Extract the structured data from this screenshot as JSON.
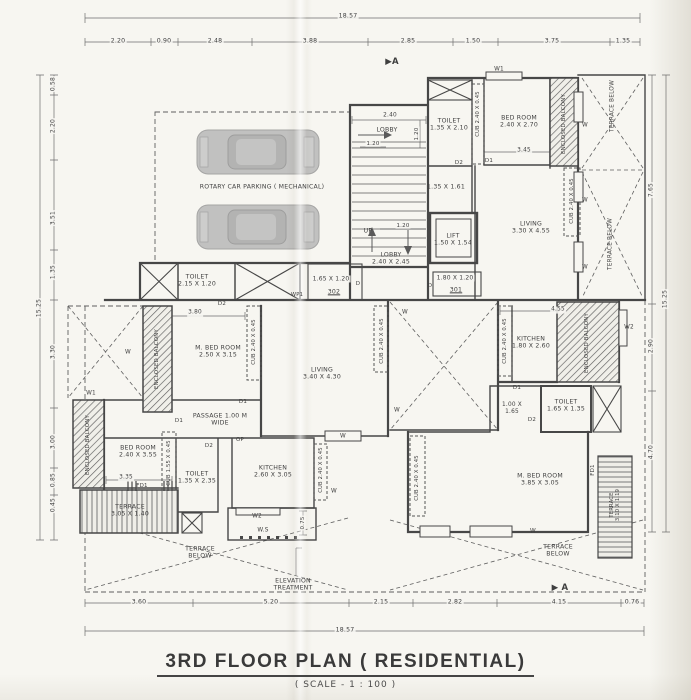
{
  "meta": {
    "title": "3RD FLOOR PLAN ( RESIDENTIAL)",
    "scale_note": "( SCALE - 1 : 100 )"
  },
  "colors": {
    "paper": "#f7f6f1",
    "ink": "#474747",
    "dim_line": "#6e6e6e",
    "car_body": "#b8b8b8"
  },
  "annotations": [
    {
      "name": "dim-top-total",
      "text": "18.57",
      "x": 348,
      "y": 16,
      "size": 6.2,
      "bg": true
    },
    {
      "name": "dim-top-1",
      "text": "2.20",
      "x": 118,
      "y": 41,
      "size": 6.2,
      "bg": true
    },
    {
      "name": "dim-top-2",
      "text": "0.90",
      "x": 164,
      "y": 41,
      "size": 6.2,
      "bg": true
    },
    {
      "name": "dim-top-3",
      "text": "2.48",
      "x": 215,
      "y": 41,
      "size": 6.2,
      "bg": true
    },
    {
      "name": "dim-top-4",
      "text": "3.88",
      "x": 310,
      "y": 41,
      "size": 6.2,
      "bg": true
    },
    {
      "name": "dim-top-5",
      "text": "2.85",
      "x": 408,
      "y": 41,
      "size": 6.2,
      "bg": true
    },
    {
      "name": "dim-top-6",
      "text": "1.50",
      "x": 473,
      "y": 41,
      "size": 6.2,
      "bg": true
    },
    {
      "name": "dim-top-7",
      "text": "3.75",
      "x": 552,
      "y": 41,
      "size": 6.2,
      "bg": true
    },
    {
      "name": "dim-top-8",
      "text": "1.35",
      "x": 623,
      "y": 41,
      "size": 6.2,
      "bg": true
    },
    {
      "name": "dim-bottom-1",
      "text": "3.60",
      "x": 139,
      "y": 602,
      "size": 6.2,
      "bg": true
    },
    {
      "name": "dim-bottom-2",
      "text": "5.20",
      "x": 271,
      "y": 602,
      "size": 6.2,
      "bg": true
    },
    {
      "name": "dim-bottom-3",
      "text": "2.15",
      "x": 381,
      "y": 602,
      "size": 6.2,
      "bg": true
    },
    {
      "name": "dim-bottom-4",
      "text": "2.82",
      "x": 455,
      "y": 602,
      "size": 6.2,
      "bg": true
    },
    {
      "name": "dim-bottom-5",
      "text": "4.15",
      "x": 559,
      "y": 602,
      "size": 6.2,
      "bg": true
    },
    {
      "name": "dim-bottom-6",
      "text": "0.76",
      "x": 632,
      "y": 602,
      "size": 6.2,
      "bg": true
    },
    {
      "name": "dim-bottom-total",
      "text": "18.57",
      "x": 345,
      "y": 630,
      "size": 6.2,
      "bg": true
    },
    {
      "name": "dim-left-1",
      "text": "0.58",
      "x": 53,
      "y": 84,
      "rot": -90,
      "size": 6,
      "bg": true
    },
    {
      "name": "dim-left-2",
      "text": "2.20",
      "x": 53,
      "y": 126,
      "rot": -90,
      "size": 6,
      "bg": true
    },
    {
      "name": "dim-left-3",
      "text": "3.51",
      "x": 53,
      "y": 218,
      "rot": -90,
      "size": 6,
      "bg": true
    },
    {
      "name": "dim-left-4",
      "text": "1.35",
      "x": 53,
      "y": 272,
      "rot": -90,
      "size": 6,
      "bg": true
    },
    {
      "name": "dim-left-total",
      "text": "15.25",
      "x": 39,
      "y": 308,
      "rot": -90,
      "size": 6,
      "bg": true
    },
    {
      "name": "dim-left-5",
      "text": "3.30",
      "x": 53,
      "y": 352,
      "rot": -90,
      "size": 6,
      "bg": true
    },
    {
      "name": "dim-left-6",
      "text": "3.00",
      "x": 53,
      "y": 442,
      "rot": -90,
      "size": 6,
      "bg": true
    },
    {
      "name": "dim-left-7",
      "text": "0.85",
      "x": 53,
      "y": 480,
      "rot": -90,
      "size": 6,
      "bg": true
    },
    {
      "name": "dim-left-8",
      "text": "0.45",
      "x": 53,
      "y": 505,
      "rot": -90,
      "size": 6,
      "bg": true
    },
    {
      "name": "dim-right-1",
      "text": "7.65",
      "x": 651,
      "y": 190,
      "rot": -90,
      "size": 6,
      "bg": true
    },
    {
      "name": "dim-right-2",
      "text": "2.90",
      "x": 651,
      "y": 346,
      "rot": -90,
      "size": 6,
      "bg": true
    },
    {
      "name": "dim-right-3",
      "text": "4.70",
      "x": 651,
      "y": 452,
      "rot": -90,
      "size": 6,
      "bg": true
    },
    {
      "name": "dim-right-total",
      "text": "15.25",
      "x": 665,
      "y": 299,
      "rot": -90,
      "size": 6,
      "bg": true
    },
    {
      "name": "section-marker-top",
      "text": "▶A",
      "x": 392,
      "y": 62,
      "size": 8.5,
      "bold": true
    },
    {
      "name": "section-marker-bottom",
      "text": "▶ A",
      "x": 560,
      "y": 588,
      "size": 8.5,
      "bold": true
    },
    {
      "name": "parking-label",
      "text": "ROTARY CAR PARKING ( MECHANICAL)",
      "x": 262,
      "y": 187,
      "size": 6.2
    },
    {
      "name": "dim-stair-width",
      "text": "2.40",
      "x": 390,
      "y": 116,
      "size": 5.8,
      "bg": true
    },
    {
      "name": "lobby-upper-label",
      "text": "LOBBY",
      "x": 387,
      "y": 130,
      "size": 6.2
    },
    {
      "name": "dim-lobby-1",
      "text": "1.20",
      "x": 373,
      "y": 144,
      "size": 5.5,
      "bg": true
    },
    {
      "name": "dim-lobby-2",
      "text": "1.20",
      "x": 417,
      "y": 134,
      "rot": -90,
      "size": 5.5,
      "bg": true
    },
    {
      "name": "stair-up-label",
      "text": "UP",
      "x": 368,
      "y": 231,
      "size": 6.2
    },
    {
      "name": "dim-stair-landing",
      "text": "1.20",
      "x": 403,
      "y": 226,
      "size": 5.5,
      "bg": true
    },
    {
      "name": "lobby-main-label",
      "text": "LOBBY\n2.40 X 2.45",
      "x": 391,
      "y": 259,
      "size": 6.2
    },
    {
      "name": "lift-label",
      "text": "LIFT\n1.50 X 1.54",
      "x": 453,
      "y": 240,
      "size": 6.2
    },
    {
      "name": "passage-161-label",
      "text": "1.35 X 1.61",
      "x": 446,
      "y": 187,
      "size": 6.2
    },
    {
      "name": "duct-301-size",
      "text": "1.80 X 1.20",
      "x": 455,
      "y": 278,
      "size": 6,
      "bg": true
    },
    {
      "name": "duct-301-label",
      "text": "301",
      "x": 456,
      "y": 290,
      "size": 6.2,
      "underline": true
    },
    {
      "name": "door-301",
      "text": "D",
      "x": 430,
      "y": 286,
      "size": 5.5
    },
    {
      "name": "duct-302-size",
      "text": "1.65 X 1.20",
      "x": 331,
      "y": 279,
      "size": 6,
      "bg": true
    },
    {
      "name": "duct-302-label",
      "text": "302",
      "x": 334,
      "y": 292,
      "size": 6.2,
      "underline": true
    },
    {
      "name": "door-302",
      "text": "D",
      "x": 358,
      "y": 284,
      "size": 5.5
    },
    {
      "name": "vent-wp1",
      "text": "WP1",
      "x": 297,
      "y": 295,
      "size": 5.2
    },
    {
      "name": "toilet-tr-label",
      "text": "TOILET\n1.35 X 2.10",
      "x": 449,
      "y": 125,
      "size": 6.2
    },
    {
      "name": "cub-tr-label",
      "text": "CUB 2.40 X 0.45",
      "x": 478,
      "y": 114,
      "rot": -90,
      "size": 5.2
    },
    {
      "name": "bedroom-tr-label",
      "text": "BED ROOM\n2.40 X 2.70",
      "x": 519,
      "y": 122,
      "size": 6.2
    },
    {
      "name": "window-w1-top",
      "text": "W1",
      "x": 499,
      "y": 70,
      "size": 5.8
    },
    {
      "name": "balcony-tr-label",
      "text": "ENCLOSED BALCONY",
      "x": 564,
      "y": 124,
      "rot": -90,
      "size": 5.4
    },
    {
      "name": "dim-bedroom-tr",
      "text": "3.45",
      "x": 524,
      "y": 151,
      "size": 5.8,
      "bg": true
    },
    {
      "name": "door-d2-tr",
      "text": "D2",
      "x": 459,
      "y": 163,
      "size": 5.5
    },
    {
      "name": "door-d1-tr",
      "text": "D1",
      "x": 489,
      "y": 161,
      "size": 5.5
    },
    {
      "name": "living-tr-label",
      "text": "LIVING\n3.30 X 4.55",
      "x": 531,
      "y": 228,
      "size": 6.2
    },
    {
      "name": "cub-tr2-label",
      "text": "CUB 2.40 X 0.45",
      "x": 572,
      "y": 201,
      "rot": -90,
      "size": 5.2
    },
    {
      "name": "window-w-tr1",
      "text": "W",
      "x": 585,
      "y": 126,
      "size": 5.8
    },
    {
      "name": "window-w-tr2",
      "text": "W",
      "x": 585,
      "y": 201,
      "size": 5.8
    },
    {
      "name": "window-w-tr3",
      "text": "W",
      "x": 585,
      "y": 268,
      "size": 5.8
    },
    {
      "name": "terrace-below-tr1",
      "text": "TERRACE BELOW",
      "x": 613,
      "y": 106,
      "rot": -90,
      "size": 5.8
    },
    {
      "name": "terrace-below-tr2",
      "text": "TERRACE BELOW",
      "x": 611,
      "y": 244,
      "rot": -90,
      "size": 5.8
    },
    {
      "name": "toilet-tl-label",
      "text": "TOILET\n2.15 X 1.20",
      "x": 197,
      "y": 281,
      "size": 6.2
    },
    {
      "name": "door-d2-tl",
      "text": "D2",
      "x": 222,
      "y": 304,
      "size": 5.5
    },
    {
      "name": "dim-mbed-tl",
      "text": "3.80",
      "x": 195,
      "y": 313,
      "size": 5.8,
      "bg": true
    },
    {
      "name": "window-w-ml",
      "text": "W",
      "x": 128,
      "y": 353,
      "size": 5.8
    },
    {
      "name": "balcony-ml-label",
      "text": "ENCLOSED BALCONY",
      "x": 157,
      "y": 359,
      "rot": -90,
      "size": 5.4
    },
    {
      "name": "mbedroom-ml-label",
      "text": "M. BED ROOM\n2.50 X 3.15",
      "x": 218,
      "y": 352,
      "size": 6.2
    },
    {
      "name": "cub-ml-label",
      "text": "CUB 2.40 X 0.45",
      "x": 254,
      "y": 342,
      "rot": -90,
      "size": 5.2
    },
    {
      "name": "living-ml-label",
      "text": "LIVING\n3.40 X 4.30",
      "x": 322,
      "y": 374,
      "size": 6.2
    },
    {
      "name": "window-w1-ml",
      "text": "W1",
      "x": 91,
      "y": 394,
      "size": 5.8
    },
    {
      "name": "balcony-ml2-label",
      "text": "ENCLOSED BALCONY",
      "x": 88,
      "y": 445,
      "rot": -90,
      "size": 5.4
    },
    {
      "name": "passage-label",
      "text": "PASSAGE 1.00 M\nWIDE",
      "x": 220,
      "y": 420,
      "size": 6.2
    },
    {
      "name": "door-d1-passage",
      "text": "D1",
      "x": 179,
      "y": 421,
      "size": 5.5
    },
    {
      "name": "door-d1-living",
      "text": "D1",
      "x": 243,
      "y": 402,
      "size": 5.5
    },
    {
      "name": "opening-op",
      "text": "OP",
      "x": 240,
      "y": 440,
      "size": 5.5
    },
    {
      "name": "bedroom-bl-label",
      "text": "BED ROOM\n2.40 X 3.55",
      "x": 138,
      "y": 452,
      "size": 6.2
    },
    {
      "name": "cub-bl-label",
      "text": "CUB 1.55 X 0.45",
      "x": 169,
      "y": 463,
      "rot": -90,
      "size": 5.2
    },
    {
      "name": "door-d2-bl",
      "text": "D2",
      "x": 209,
      "y": 446,
      "size": 5.5
    },
    {
      "name": "toilet-bl-label",
      "text": "TOILET\n1.35 X 2.35",
      "x": 197,
      "y": 478,
      "size": 6.2
    },
    {
      "name": "kitchen-bl-label",
      "text": "KITCHEN\n2.60 X 3.05",
      "x": 273,
      "y": 472,
      "size": 6.2
    },
    {
      "name": "dim-bedroom-bl",
      "text": "3.35",
      "x": 126,
      "y": 478,
      "size": 5.8,
      "bg": true
    },
    {
      "name": "door-fd1-bl",
      "text": "FD1",
      "x": 142,
      "y": 486,
      "size": 5.5
    },
    {
      "name": "terrace-bl-label",
      "text": "TERRACE\n3.05 X 1.40",
      "x": 130,
      "y": 511,
      "size": 6.2
    },
    {
      "name": "cub-kitchen-bl",
      "text": "CUB 2.40 X 0.45",
      "x": 321,
      "y": 470,
      "rot": -90,
      "size": 5.2
    },
    {
      "name": "window-w-kitchen-bl",
      "text": "W",
      "x": 334,
      "y": 492,
      "size": 5.8
    },
    {
      "name": "window-w-living-b",
      "text": "W",
      "x": 343,
      "y": 437,
      "size": 5.8
    },
    {
      "name": "window-w-living-r",
      "text": "W",
      "x": 397,
      "y": 411,
      "size": 5.8
    },
    {
      "name": "dim-kitchen-tr",
      "text": "4.55",
      "x": 558,
      "y": 310,
      "size": 5.8,
      "bg": true
    },
    {
      "name": "kitchen-mr-label",
      "text": "KITCHEN\n1.80 X 2.60",
      "x": 531,
      "y": 343,
      "size": 6.2
    },
    {
      "name": "cub-mr1-label",
      "text": "CUB 2.40 X 0.45",
      "x": 505,
      "y": 341,
      "rot": -90,
      "size": 5.2
    },
    {
      "name": "cub-mr2-label",
      "text": "CUB 2.40 X 0.45",
      "x": 382,
      "y": 341,
      "rot": -90,
      "size": 5.2
    },
    {
      "name": "window-w-mr",
      "text": "W",
      "x": 405,
      "y": 313,
      "size": 5.8
    },
    {
      "name": "balcony-mr-label",
      "text": "ENCLOSED BALCONY",
      "x": 587,
      "y": 343,
      "rot": -90,
      "size": 5.4
    },
    {
      "name": "window-w2-mr",
      "text": "W2",
      "x": 629,
      "y": 328,
      "size": 5.8
    },
    {
      "name": "door-d1-mr",
      "text": "D1",
      "x": 517,
      "y": 388,
      "size": 5.5
    },
    {
      "name": "lobby-mr-size",
      "text": "1.00 X\n1.65",
      "x": 512,
      "y": 409,
      "size": 5.8
    },
    {
      "name": "door-d2-mr",
      "text": "D2",
      "x": 532,
      "y": 420,
      "size": 5.5
    },
    {
      "name": "toilet-mr-label",
      "text": "TOILET\n1.65 X 1.35",
      "x": 566,
      "y": 406,
      "size": 6.2
    },
    {
      "name": "mbedroom-br-label",
      "text": "M. BED ROOM\n3.85 X 3.05",
      "x": 540,
      "y": 480,
      "size": 6.2
    },
    {
      "name": "cub-br-label",
      "text": "CUB 2.40 X 0.45",
      "x": 417,
      "y": 478,
      "rot": -90,
      "size": 5.2
    },
    {
      "name": "door-fd1-br",
      "text": "FD1",
      "x": 593,
      "y": 470,
      "rot": -90,
      "size": 5.5
    },
    {
      "name": "terrace-br-label",
      "text": "TERRACE\n3.10 X 1.19",
      "x": 615,
      "y": 505,
      "rot": -90,
      "size": 5.2
    },
    {
      "name": "window-w-br",
      "text": "W",
      "x": 533,
      "y": 532,
      "size": 5.8
    },
    {
      "name": "window-w2-ws",
      "text": "W2",
      "x": 257,
      "y": 517,
      "size": 5.8
    },
    {
      "name": "ws-label",
      "text": "W.S",
      "x": 263,
      "y": 531,
      "size": 5.8
    },
    {
      "name": "dim-ws",
      "text": "0.75",
      "x": 303,
      "y": 523,
      "rot": -90,
      "size": 5.5,
      "bg": true
    },
    {
      "name": "terrace-below-bl",
      "text": "TERRACE\nBELOW",
      "x": 200,
      "y": 553,
      "size": 6.2
    },
    {
      "name": "terrace-below-br",
      "text": "TERRACE\nBELOW",
      "x": 558,
      "y": 551,
      "size": 6.2
    },
    {
      "name": "elevation-treatment-label",
      "text": "ELEVATION\nTREATMENT",
      "x": 293,
      "y": 585,
      "size": 6.2
    }
  ]
}
